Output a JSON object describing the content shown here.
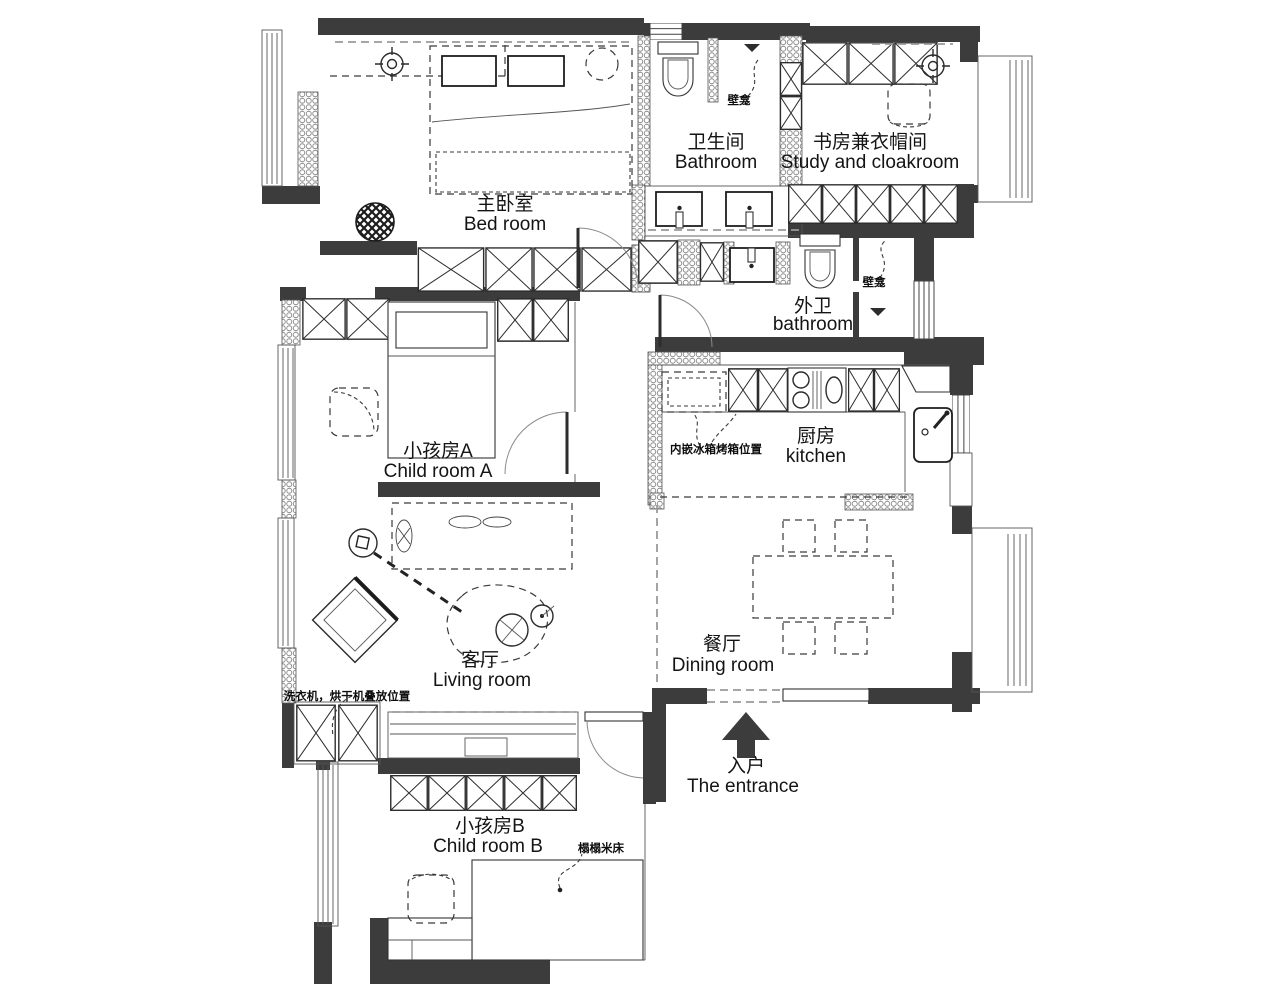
{
  "title": "Apartment floor plan",
  "colors": {
    "wall": "#3c3c3c",
    "line": "#2b2b2b",
    "background": "#ffffff"
  },
  "rooms": {
    "bedroom": {
      "zh": "主卧室",
      "en": "Bed room"
    },
    "bathroom": {
      "zh": "卫生间",
      "en": "Bathroom"
    },
    "study": {
      "zh": "书房兼衣帽间",
      "en": "Study and cloakroom"
    },
    "second_bathroom": {
      "zh": "外卫",
      "en": "bathroom"
    },
    "child_room_a": {
      "zh": "小孩房A",
      "en": "Child room A"
    },
    "kitchen": {
      "zh": "厨房",
      "en": "kitchen"
    },
    "living_room": {
      "zh": "客厅",
      "en": "Living room"
    },
    "dining_room": {
      "zh": "餐厅",
      "en": "Dining room"
    },
    "child_room_b": {
      "zh": "小孩房B",
      "en": "Child room B"
    },
    "entrance": {
      "zh": "入户",
      "en": "The entrance"
    }
  },
  "annotations": {
    "niche_top": "壁龛",
    "niche_side": "壁龛",
    "fridge_oven": "内嵌冰箱烤箱位置",
    "washer_dryer": "洗衣机，烘干机叠放位置",
    "tatami_bed": "榻榻米床"
  }
}
